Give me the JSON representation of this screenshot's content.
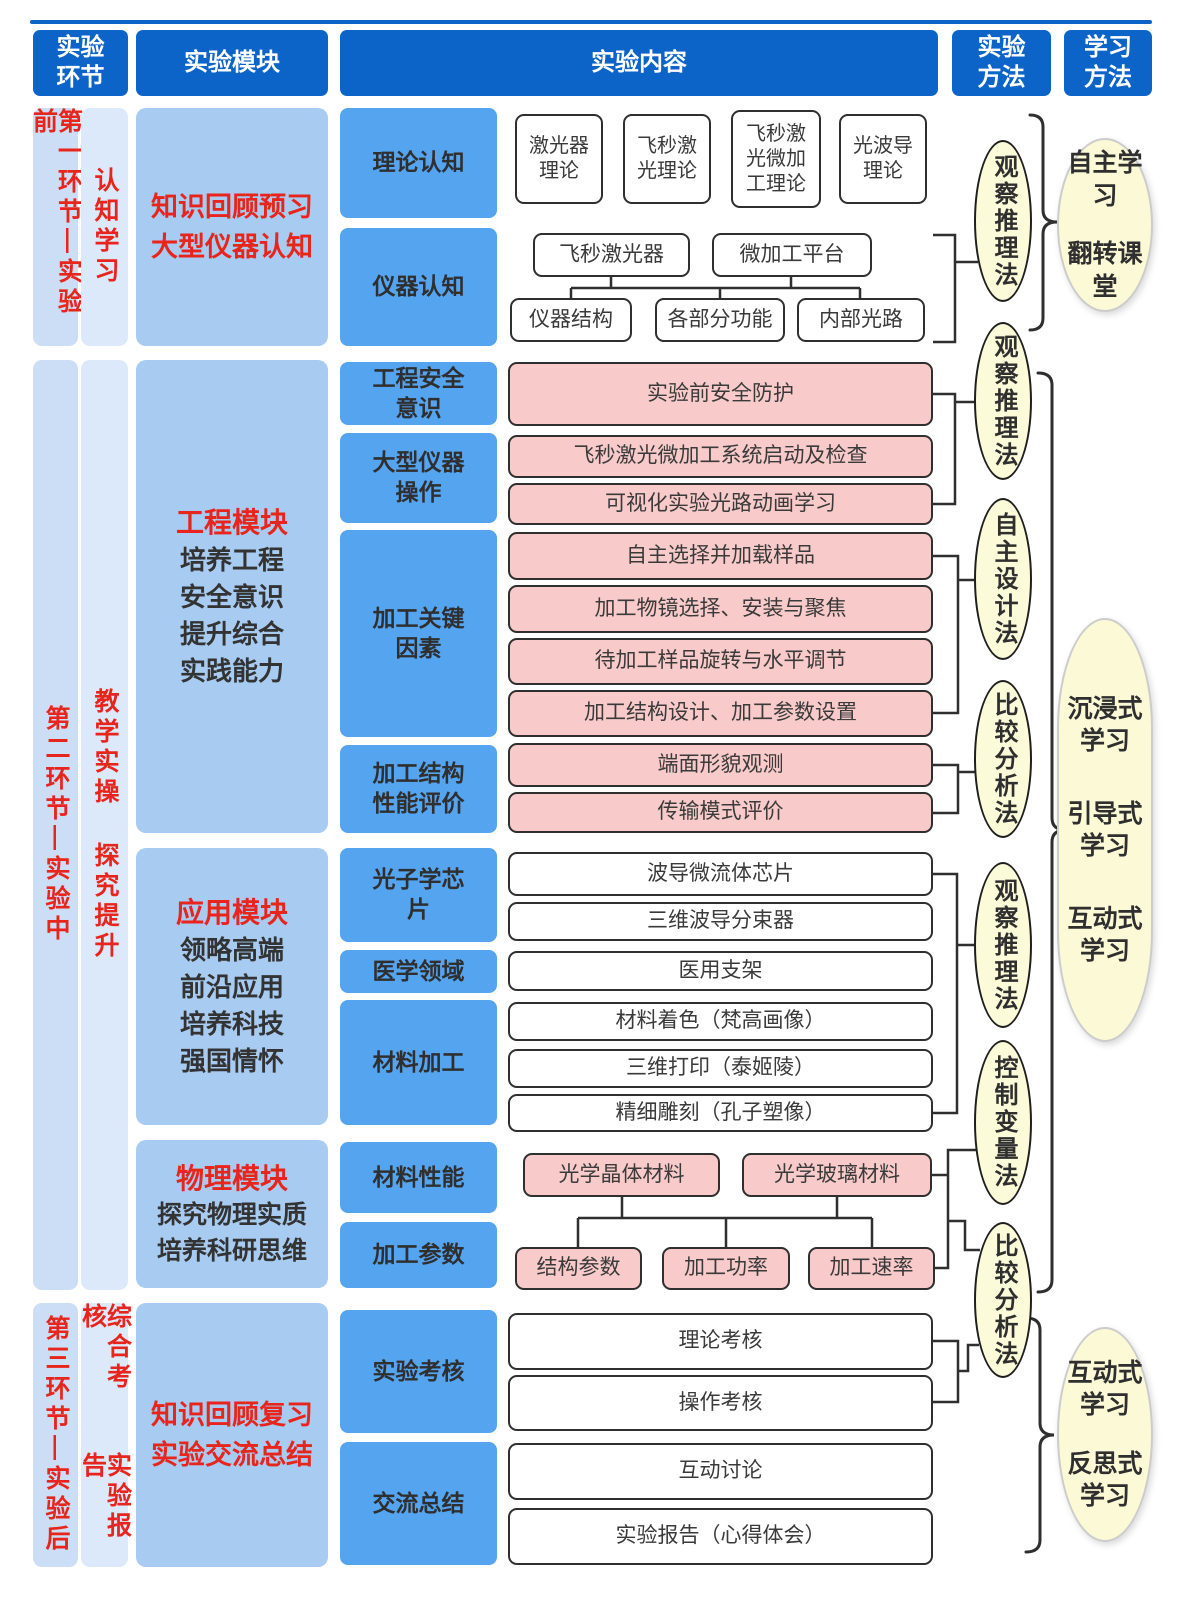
{
  "headers": {
    "h1": "实验环节",
    "h2": "实验模块",
    "h3": "实验内容",
    "h4": "实验方法",
    "h5": "学习方法"
  },
  "phases": {
    "p1": {
      "stage": "第一环节—实验前",
      "tags": [
        "认知学习"
      ]
    },
    "p2": {
      "stage": "第二环节—实验中",
      "tags": [
        "教学实操",
        "探究提升"
      ]
    },
    "p3": {
      "stage": "第三环节—实验后",
      "tags": [
        "综合考核",
        "实验报告"
      ]
    }
  },
  "modules": {
    "m1": {
      "lines": [
        "知识回顾预习",
        "大型仪器认知"
      ]
    },
    "m2": {
      "title": "工程模块",
      "desc": [
        "培养工程",
        "安全意识",
        "提升综合",
        "实践能力"
      ]
    },
    "m3": {
      "title": "应用模块",
      "desc": [
        "领略高端",
        "前沿应用",
        "培养科技",
        "强国情怀"
      ]
    },
    "m4": {
      "title": "物理模块",
      "desc": [
        "探究物理实质",
        "培养科研思维"
      ]
    },
    "m5": {
      "lines": [
        "知识回顾复习",
        "实验交流总结"
      ]
    }
  },
  "categories": [
    "理论认知",
    "仪器认知",
    "工程安全意识",
    "大型仪器操作",
    "加工关键因素",
    "加工结构性能评价",
    "光子学芯片",
    "医学领域",
    "材料加工",
    "材料性能",
    "加工参数",
    "实验考核",
    "交流总结"
  ],
  "content": {
    "theory": [
      "激光器理论",
      "飞秒激光理论",
      "飞秒激光微加工理论",
      "光波导理论"
    ],
    "instrument_top": [
      "飞秒激光器",
      "微加工平台"
    ],
    "instrument_bottom": [
      "仪器结构",
      "各部分功能",
      "内部光路"
    ],
    "engineering": [
      "实验前安全防护",
      "飞秒激光微加工系统启动及检查",
      "可视化实验光路动画学习",
      "自主选择并加载样品",
      "加工物镜选择、安装与聚焦",
      "待加工样品旋转与水平调节",
      "加工结构设计、加工参数设置",
      "端面形貌观测",
      "传输模式评价"
    ],
    "application": [
      "波导微流体芯片",
      "三维波导分束器",
      "医用支架",
      "材料着色（梵高画像）",
      "三维打印（泰姬陵）",
      "精细雕刻（孔子塑像）"
    ],
    "materials": [
      "光学晶体材料",
      "光学玻璃材料"
    ],
    "parameters": [
      "结构参数",
      "加工功率",
      "加工速率"
    ],
    "assessment": [
      "理论考核",
      "操作考核",
      "互动讨论",
      "实验报告（心得体会）"
    ]
  },
  "methods": [
    "观察推理法",
    "观察推理法",
    "自主设计法",
    "比较分析法",
    "观察推理法",
    "控制变量法",
    "比较分析法"
  ],
  "learning": {
    "L1": [
      "自主学习",
      "翻转课堂"
    ],
    "L2": [
      "沉浸式学习",
      "引导式学习",
      "互动式学习"
    ],
    "L3": [
      "互动式学习",
      "反思式学习"
    ]
  },
  "colors": {
    "header_blue": "#0c63c8",
    "category_blue": "#55a4f0",
    "module_blue": "#a7cbf1",
    "phase_strip": "#cbdef5",
    "phase_strip_light": "#dbe9fb",
    "pink": "#f8caca",
    "method_yellow": "#fbfad9",
    "accent_red": "#e8251d",
    "line_dark": "#2f2f2f"
  }
}
